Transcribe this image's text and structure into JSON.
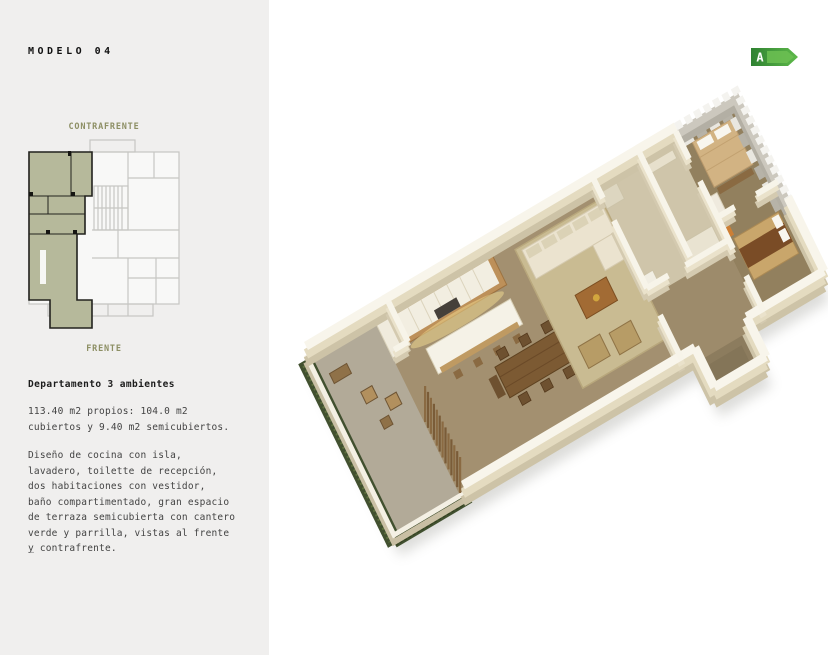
{
  "sidebar": {
    "title": "MODELO 04",
    "contrafrente_label": "CONTRAFRENTE",
    "frente_label": "FRENTE",
    "heading": "Departamento 3 ambientes",
    "area_text": "113.40 m2 propios: 104.0 m2\ncubiertos y 9.40 m2 semicubiertos.",
    "description": "Diseño de cocina con isla,\nlavadero, toilette de recepción,\ndos habitaciones con vestidor,\nbaño compartimentado, gran espacio\nde terraza semicubierta con cantero\nverde y parrilla, vistas al frente\ny contrafrente.",
    "footer_dash": "—"
  },
  "mini_plan": {
    "highlight_color": "#b6b99b",
    "outline_color": "#22221e",
    "grid_color": "#c6c6c3"
  },
  "badge": {
    "label": "A",
    "color_dark": "#2f8232",
    "color_light": "#5eb94a"
  },
  "render": {
    "wall_color": "#f8f5eb",
    "wall_shade_color": "#e4dbc0",
    "floor_color": "#a39070",
    "terrace_floor_color": "#b2aa98",
    "rug_color": "#c9bb92",
    "hedge_color": "#41502f",
    "accent_olive": "#8d8f64"
  }
}
